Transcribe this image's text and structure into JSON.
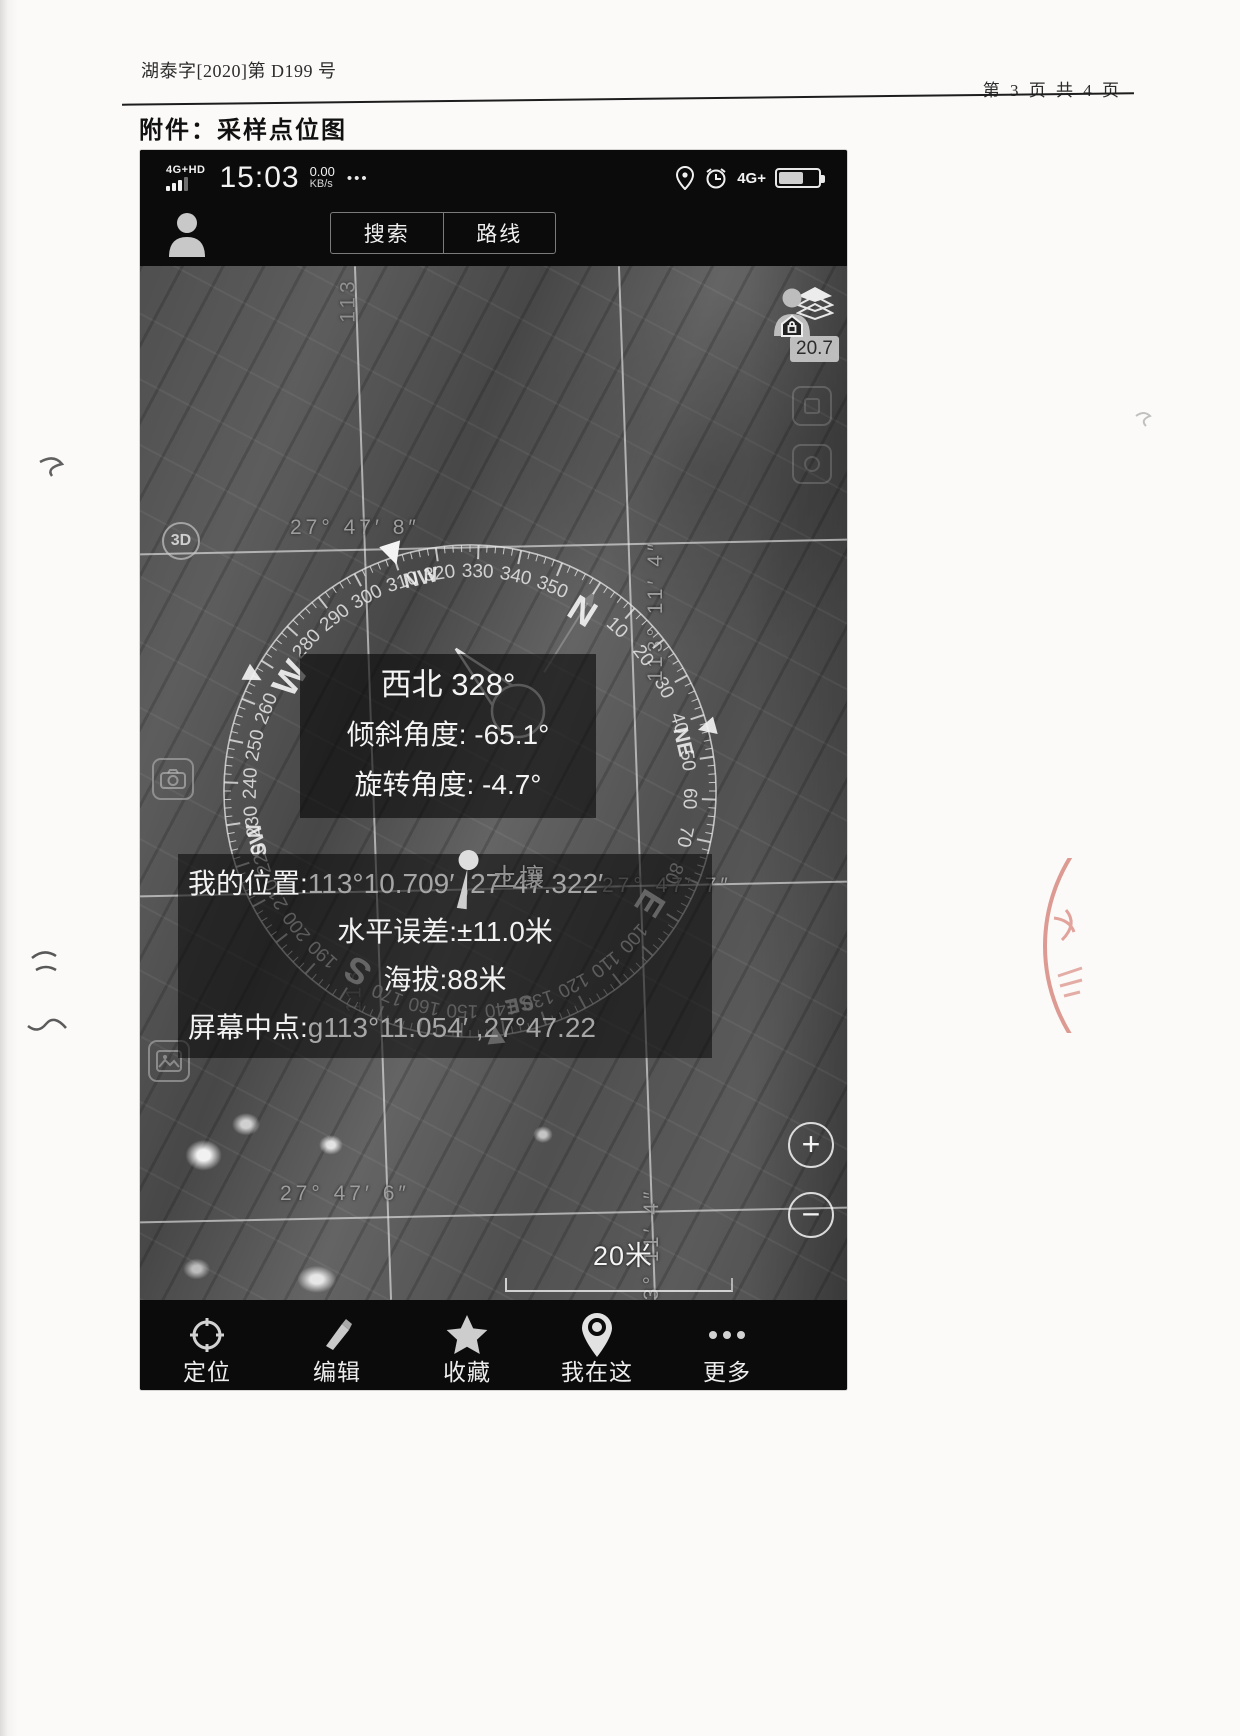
{
  "page": {
    "doc_number": "湖泰字[2020]第 D199 号",
    "page_indicator": "第 3 页 共 4 页",
    "attachment_title": "附件：采样点位图"
  },
  "phone": {
    "status_bar": {
      "network": "4G+HD",
      "time": "15:03",
      "net_speed": "0.00",
      "net_speed_unit": "KB/s",
      "more_dots": "•••",
      "network_type": "4G+"
    },
    "nav": {
      "search": "搜索",
      "route": "路线"
    },
    "map": {
      "zoom_badge": "20.7",
      "button_3d": "3D",
      "google": "Googl",
      "scale_label": "20米",
      "pin_label": "土壤",
      "grid": {
        "top_lat": "27° 47′ 8″",
        "bottom_lat": "27° 47′ 6″",
        "mid_lat": "27° 47′ 7″",
        "right_lon_upper": "113° 11′ 4″",
        "right_lon_lower": "113° 11′ 4″",
        "top_lon_partial": "113",
        "mid_lon_partial": "113"
      }
    },
    "compass": {
      "heading_line": "西北 328°",
      "tilt_line": "倾斜角度: -65.1°",
      "roll_line": "旋转角度: -4.7°",
      "heading_deg": 328,
      "cardinals": [
        "N",
        "NE",
        "E",
        "SE",
        "S",
        "SW",
        "W",
        "NW"
      ],
      "degree_labels": [
        10,
        20,
        30,
        40,
        50,
        60,
        70,
        80,
        100,
        110,
        120,
        130,
        140,
        150,
        160,
        170,
        190,
        200,
        210,
        220,
        230,
        240,
        250,
        260,
        280,
        290,
        300,
        310,
        320,
        330,
        340,
        350
      ]
    },
    "info": {
      "my_location_label": "我的位置:",
      "my_location_value": "113°10.709′  ,27°47.322′",
      "horizontal_error": "水平误差:±11.0米",
      "altitude": "海拔:88米",
      "screen_center_label": "屏幕中点:",
      "screen_center_value": "g113°11.054′   ,27°47.22"
    },
    "toolbar": [
      {
        "label": "定位",
        "icon": "locate-icon"
      },
      {
        "label": "编辑",
        "icon": "pencil-icon"
      },
      {
        "label": "收藏",
        "icon": "star-icon"
      },
      {
        "label": "我在这",
        "icon": "pin-icon"
      },
      {
        "label": "更多",
        "icon": "more-dots-icon"
      }
    ]
  },
  "colors": {
    "stamp_red": "#c0392b",
    "overlay_text": "#f2f2f2",
    "dim_coord_text": "#a6a6a6"
  }
}
